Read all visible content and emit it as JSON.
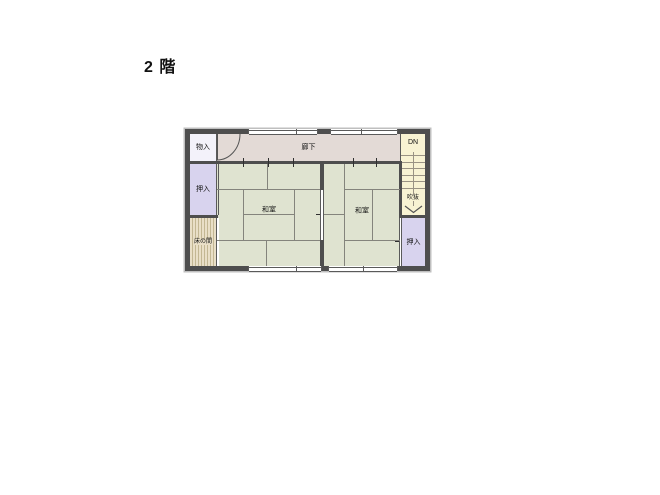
{
  "title": "2 階",
  "floor_plan": {
    "rooms": {
      "monoire": {
        "label": "物入"
      },
      "oshiire_left": {
        "label": "押入"
      },
      "tokonoma": {
        "label": "床の間"
      },
      "rouka": {
        "label": "廊下"
      },
      "stairs_dn": {
        "label": "DN"
      },
      "fukinuke": {
        "label": "吹抜"
      },
      "washitsu_left": {
        "label": "和室"
      },
      "washitsu_right": {
        "label": "和室"
      },
      "oshiire_right": {
        "label": "押入"
      }
    },
    "colors": {
      "wall": "#4e4e4e",
      "line": "#5a5a5a",
      "tatami": "#dfe3d0",
      "tatami_line": "#84847c",
      "corridor": "#e3dad6",
      "closet": "#d8d3ee",
      "storage": "#f3f2fa",
      "tokonoma": "#e9dfc7",
      "tokonoma_stripe": "#c3b793",
      "stairs": "#f8f3d3",
      "stair_line": "#9a9384",
      "text": "#111111"
    }
  }
}
